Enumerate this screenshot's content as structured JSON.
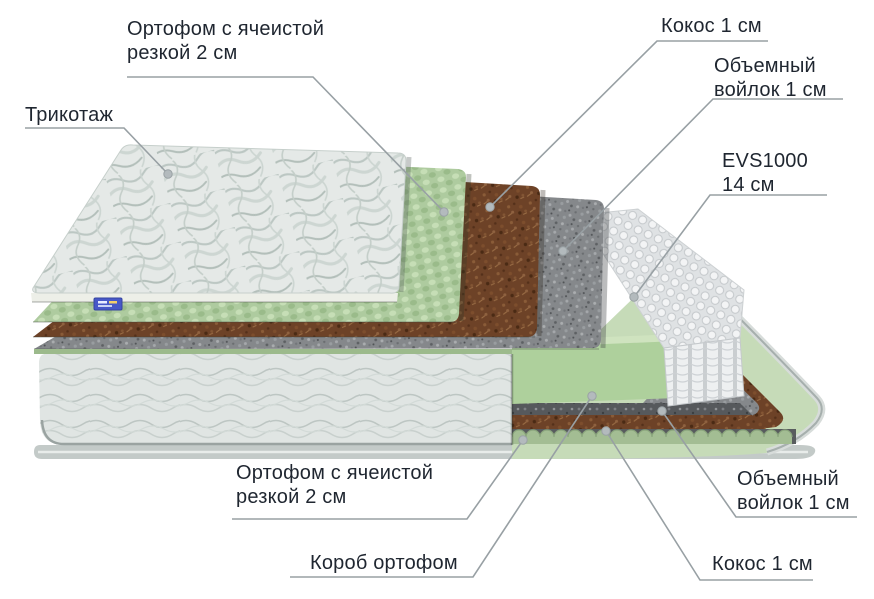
{
  "diagram": {
    "type": "mattress-layers-cutaway",
    "labels": {
      "tricot": {
        "lines": [
          "Трикотаж"
        ]
      },
      "ortho_top": {
        "lines": [
          "Ортофом с ячеистой",
          "резкой 2 см"
        ]
      },
      "coco_top": {
        "lines": [
          "Кокос 1 см"
        ]
      },
      "felt_top": {
        "lines": [
          "Объемный",
          "войлок 1 см"
        ]
      },
      "evs": {
        "lines": [
          "EVS1000",
          "14 см"
        ]
      },
      "ortho_bottom": {
        "lines": [
          "Ортофом с ячеистой",
          "резкой 2 см"
        ]
      },
      "box": {
        "lines": [
          "Короб ортофом"
        ]
      },
      "felt_bottom": {
        "lines": [
          "Объемный",
          "войлок 1 см"
        ]
      },
      "coco_bottom": {
        "lines": [
          "Кокос 1 см"
        ]
      }
    },
    "layers": [
      {
        "id": "tricot",
        "name": "Трикотаж",
        "color": "#e5e9e7"
      },
      {
        "id": "ortho_top",
        "name": "Ортофом с ячеистой резкой 2 см",
        "color": "#aecb9f"
      },
      {
        "id": "coco_top",
        "name": "Кокос 1 см",
        "color": "#6f4326"
      },
      {
        "id": "felt_top",
        "name": "Объемный войлок 1 см",
        "color": "#85888b"
      },
      {
        "id": "evs",
        "name": "EVS1000 14 см",
        "color": "#eef0f1"
      },
      {
        "id": "felt_bottom",
        "name": "Объемный войлок 1 см",
        "color": "#56595c"
      },
      {
        "id": "coco_bottom",
        "name": "Кокос 1 см",
        "color": "#6f4326"
      },
      {
        "id": "ortho_bottom",
        "name": "Ортофом с ячеистой резкой 2 см",
        "color": "#a3bd93"
      },
      {
        "id": "box",
        "name": "Короб ортофом",
        "color": "#aed09c"
      }
    ],
    "colors": {
      "text": "#1f2630",
      "leader_line": "#98a0a4",
      "leader_dot": "#b3babd",
      "tag_blue": "#4758c8",
      "base_gray": "#c3cac8"
    }
  }
}
